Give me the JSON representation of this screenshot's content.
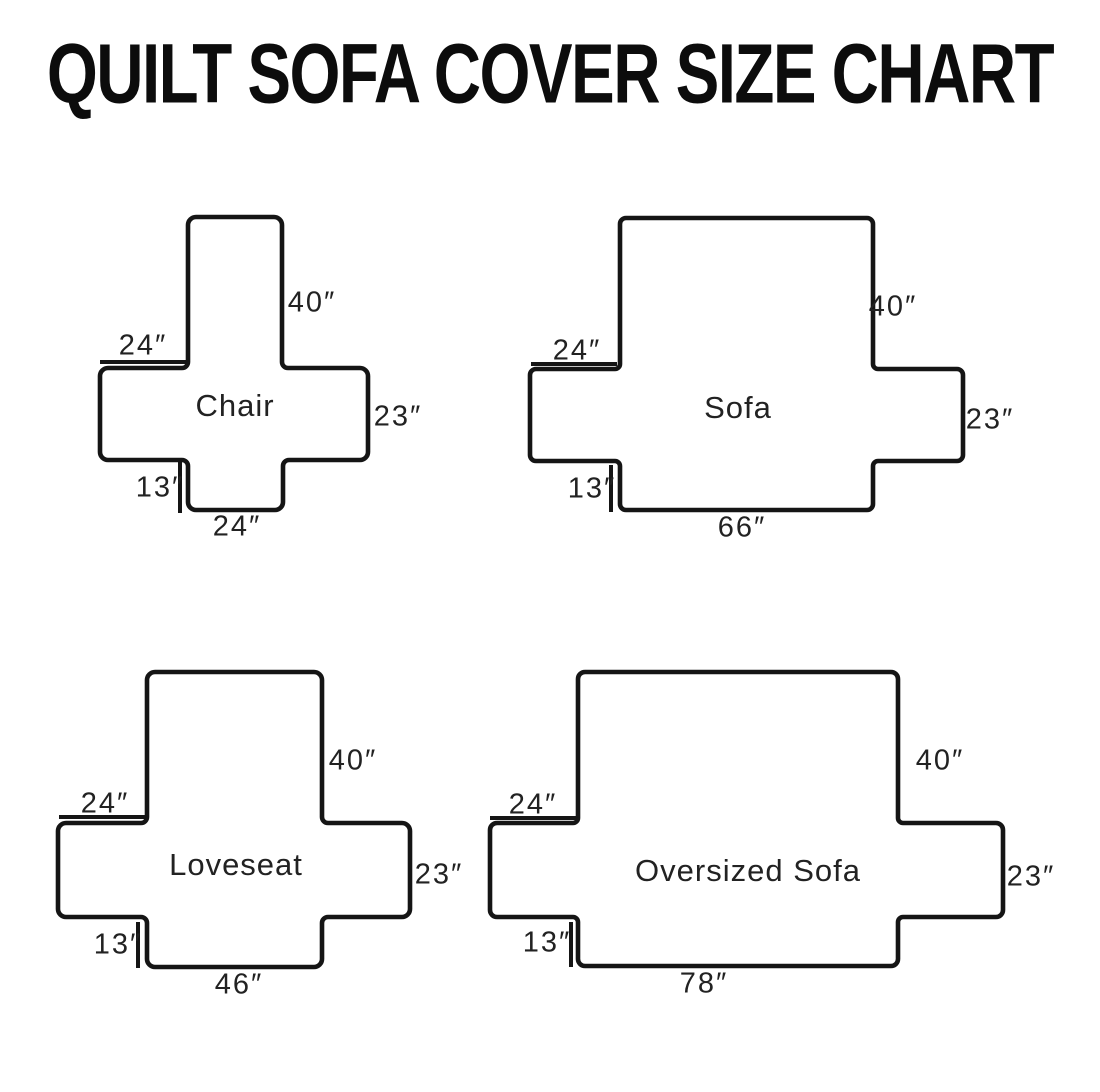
{
  "title": "QUILT SOFA COVER SIZE CHART",
  "diagrams": [
    {
      "name": "Chair",
      "back_height": "40″",
      "arm_top_width": "24″",
      "side_height": "23″",
      "front_skirt": "13″",
      "base_width": "24″"
    },
    {
      "name": "Sofa",
      "back_height": "40″",
      "arm_top_width": "24″",
      "side_height": "23″",
      "front_skirt": "13″",
      "base_width": "66″"
    },
    {
      "name": "Loveseat",
      "back_height": "40″",
      "arm_top_width": "24″",
      "side_height": "23″",
      "front_skirt": "13″",
      "base_width": "46″"
    },
    {
      "name": "Oversized Sofa",
      "back_height": "40″",
      "arm_top_width": "24″",
      "side_height": "23″",
      "front_skirt": "13″",
      "base_width": "78″"
    }
  ]
}
